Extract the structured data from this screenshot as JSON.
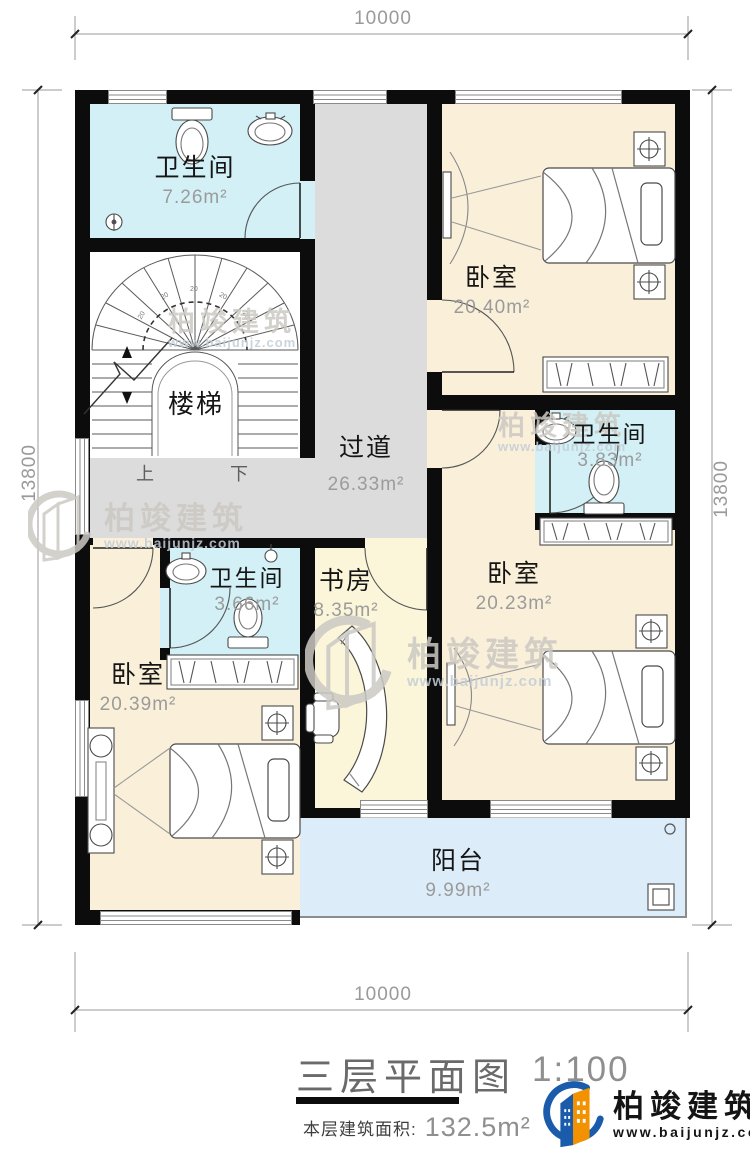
{
  "plan": {
    "dimensions": {
      "top": "10000",
      "bottom": "10000",
      "left": "13800",
      "right": "13800"
    },
    "rooms": [
      {
        "name": "卫生间",
        "area": "7.26m²"
      },
      {
        "name": "卧室",
        "area": "20.40m²"
      },
      {
        "name": "过道",
        "area": "26.33m²"
      },
      {
        "name": "卫生间",
        "area": "3.83m²"
      },
      {
        "name": "卧室",
        "area": "20.23m²"
      },
      {
        "name": "书房",
        "area": "8.35m²"
      },
      {
        "name": "卫生间",
        "area": "3.66m²"
      },
      {
        "name": "卧室",
        "area": "20.39m²"
      },
      {
        "name": "阳台",
        "area": "9.99m²"
      }
    ],
    "stairs": {
      "label": "楼梯",
      "up": "上",
      "down": "下",
      "tread_mark": "20"
    },
    "title": {
      "text": "三层平面图",
      "scale": "1:100",
      "floor_area_label": "本层建筑面积:",
      "floor_area_value": "132.5m²"
    },
    "colors": {
      "wall": "#0c0c0c",
      "bathroom": "#d2f0f5",
      "bedroom": "#faf0da",
      "study": "#fbf6d9",
      "corridor": "#dcdcdc",
      "balcony": "#dcecf9"
    }
  },
  "branding": {
    "name": "柏竣建筑",
    "url": "www.baijunjz.com"
  },
  "watermark": {
    "name": "柏竣建筑",
    "url": "www.baijunjz.com"
  }
}
